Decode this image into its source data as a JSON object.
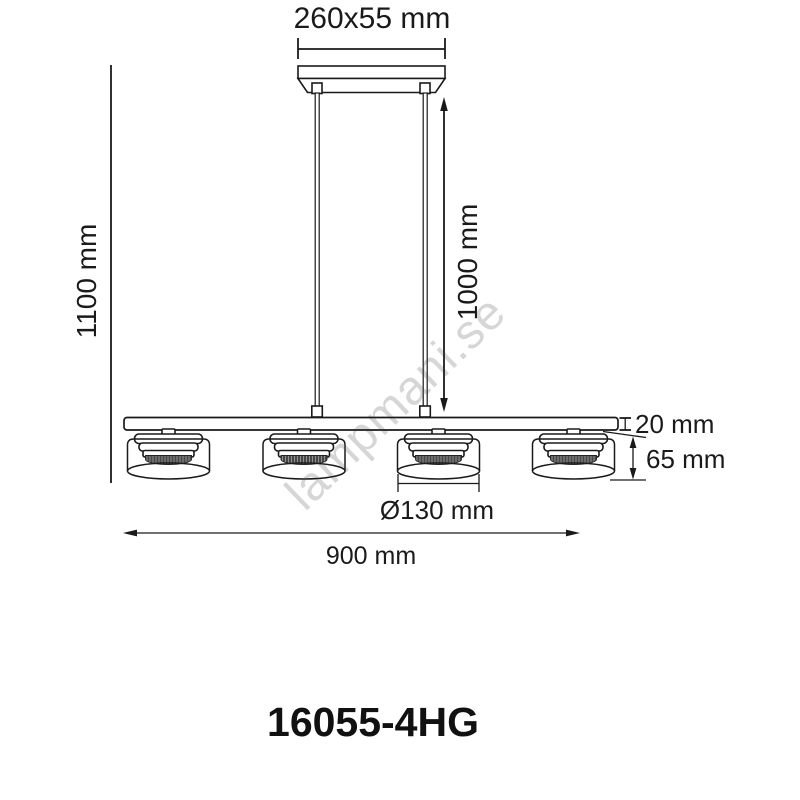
{
  "product_code": "16055-4HG",
  "watermark": "lampmani.se",
  "labels": {
    "canopy_size": "260x55 mm",
    "total_height": "1100 mm",
    "suspension_length": "1000 mm",
    "bar_thickness": "20 mm",
    "shade_height": "65 mm",
    "shade_diameter": "Ø130 mm",
    "fixture_width": "900 mm"
  },
  "figure": {
    "shade_count": 4,
    "type": "pendant-lamp-dimension-drawing"
  },
  "colors": {
    "line": "#1a1a1a",
    "text": "#111111",
    "watermark": "#d6d6d6",
    "background": "#ffffff"
  }
}
